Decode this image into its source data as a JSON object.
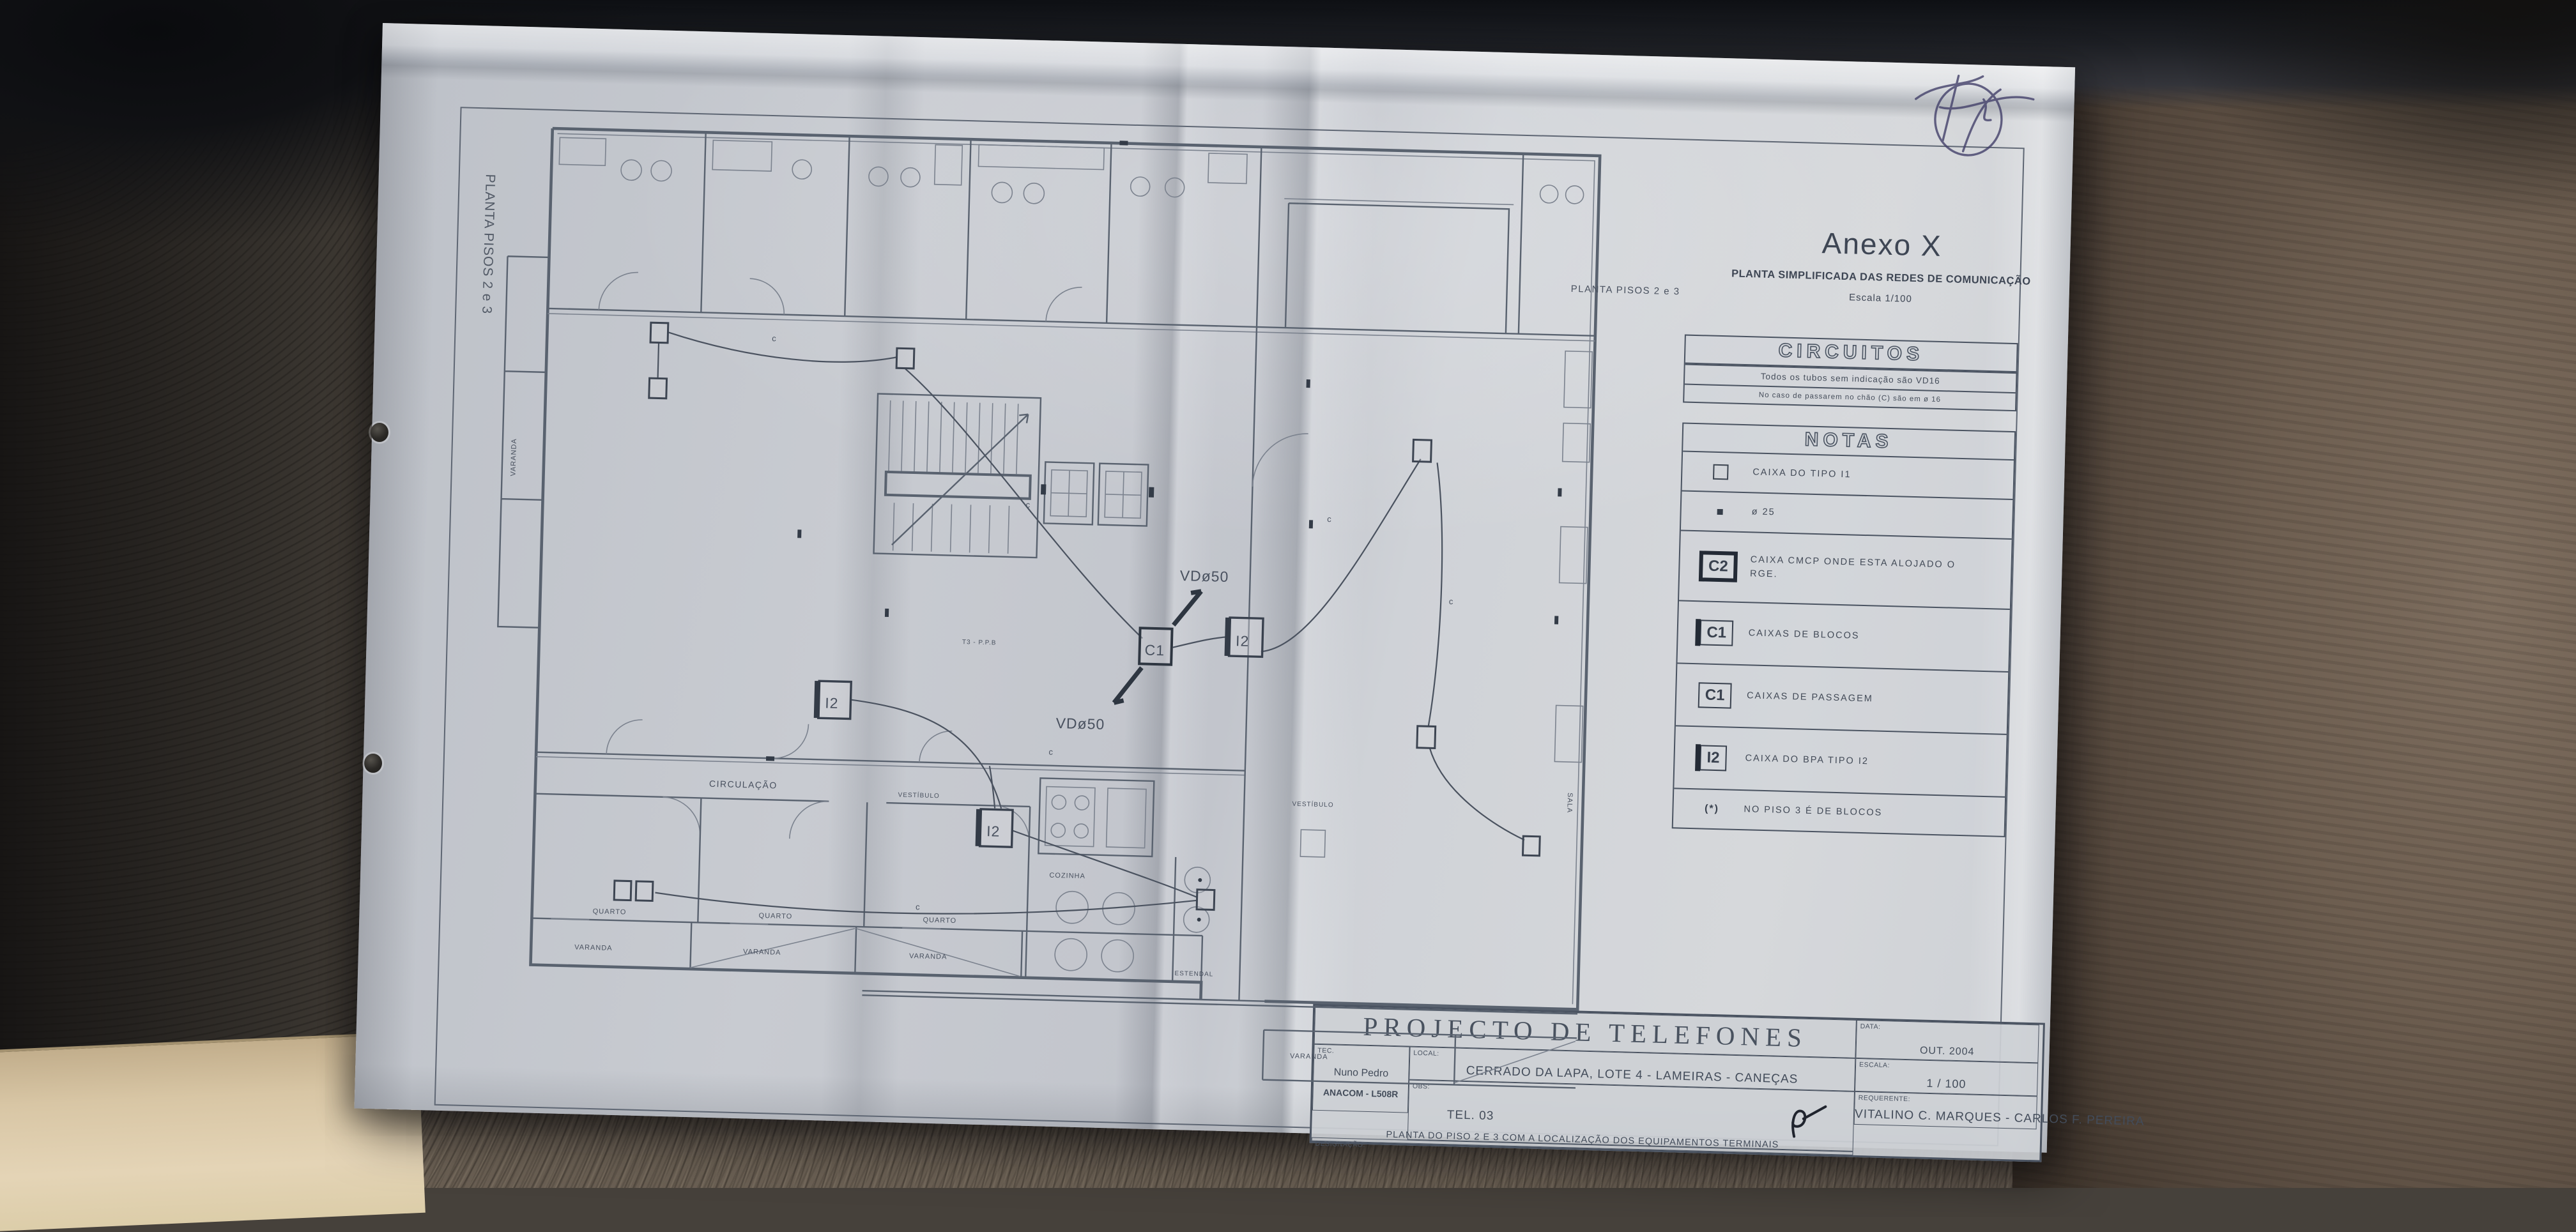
{
  "annex": {
    "title": "Anexo X",
    "subtitle": "PLANTA SIMPLIFICADA DAS REDES DE COMUNICAÇÃO",
    "scale": "Escala 1/100"
  },
  "side_label": "PLANTA PISOS 2 e 3",
  "circuitos": {
    "header": "CIRCUITOS",
    "line1": "Todos os tubos sem indicação são VD16",
    "line2": "No caso de passarem no chão (C) são em ø 16"
  },
  "notas": {
    "header": "NOTAS",
    "rows": [
      {
        "sym": "",
        "label": "CAIXA DO TIPO I1"
      },
      {
        "sym": "",
        "label": "ø 25"
      },
      {
        "sym": "C2",
        "label": "CAIXA CMCP ONDE ESTA ALOJADO O RGE."
      },
      {
        "sym": "C1",
        "label": "CAIXAS DE BLOCOS"
      },
      {
        "sym": "C1",
        "label": "CAIXAS DE PASSAGEM"
      },
      {
        "sym": "I2",
        "label": "CAIXA DO BPA TIPO I2"
      },
      {
        "sym": "(*)",
        "label": "NO PISO 3 É DE BLOCOS"
      }
    ]
  },
  "plan": {
    "circulacao": "CIRCULAÇÃO",
    "vestibulo": "VESTÍBULO",
    "quarto": "QUARTO",
    "varanda": "VARANDA",
    "cozinha": "COZINHA",
    "estendal": "ESTENDAL",
    "sala": "SALA",
    "vd50": "VDø50",
    "c1": "C1",
    "i2": "I2",
    "cable": "c",
    "t3": "T3 - P.P.B",
    "plan_title": "PLANTA PISOS 2 e 3"
  },
  "title_block": {
    "title": "PROJECTO DE TELEFONES",
    "tec_label": "TEC.",
    "tec_name": "Nuno Pedro",
    "tec_reg": "ANACOM - L508R",
    "local_label": "LOCAL:",
    "local_value": "CERRADO DA LAPA, LOTE 4 - LAMEIRAS - CANEÇAS",
    "req_label": "REQUERENTE:",
    "req_value": "VITALINO C. MARQUES - CARLOS F. PEREIRA",
    "des_label": "DESIGNAÇÃO:",
    "des_value": "PLANTA DO PISO 2 E 3 COM A LOCALIZAÇÃO DOS EQUIPAMENTOS TERMINAIS",
    "data_label": "DATA:",
    "data_value": "OUT. 2004",
    "escala_label": "ESCALA:",
    "escala_value": "1 / 100",
    "obs_label": "OBS:",
    "obs_value": "TEL. 03"
  },
  "colors": {
    "paper": "#cdd0d6",
    "ink": "#515a68",
    "leather_right": "#6b5c4e",
    "leather_bottom": "#6e6357",
    "beige_corner": "#ddcbaa",
    "signature_ink": "#43406a"
  }
}
